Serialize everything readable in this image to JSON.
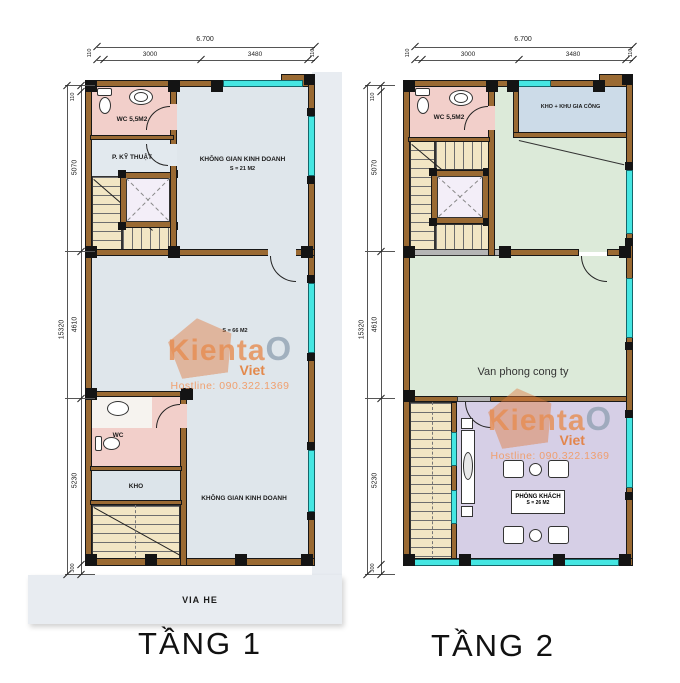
{
  "watermark": {
    "brand_main": "Kienta",
    "brand_o": "O",
    "sub": "Viet",
    "hotline": "Hostline: 090.322.1369"
  },
  "sidewalk_label": "VIA HE",
  "dims": {
    "top_total": "6.700",
    "seg_3000": "3000",
    "seg_3480": "3480",
    "end_110": "110",
    "left_total": "15320",
    "seg_110": "110",
    "seg_5070": "5070",
    "seg_4610": "4610",
    "seg_5230": "5230",
    "seg_300": "300"
  },
  "plans": [
    {
      "title": "TẦNG 1",
      "rooms": {
        "wc_top": "WC 5,5M2",
        "tech": "P. KỸ THUẬT",
        "business_top": "KHÔNG GIAN KINH DOANH",
        "business_top_area": "S = 21 M2",
        "open_area": "S = 66 M2",
        "wc_bottom": "WC",
        "storage": "KHO",
        "business_bottom": "KHÔNG GIAN KINH DOANH"
      }
    },
    {
      "title": "TẦNG 2",
      "rooms": {
        "wc_top": "WC 5,5M2",
        "storage_top": "KHO + KHU GIA CÔNG",
        "office": "Van phong cong ty",
        "living": "PHÒNG KHÁCH",
        "living_area": "S = 26 M2"
      }
    }
  ],
  "colors": {
    "wall": "#9a6a33",
    "window": "#45e6e2",
    "wc_floor": "#f2cfca",
    "retail_floor": "#dfe6eb",
    "office_floor": "#dcead9",
    "storage_floor": "#ccdbe8",
    "living_floor": "#d6cfe6",
    "stair_floor": "#f2e6c4",
    "sidewalk": "#e8ecf1",
    "watermark_orange": "#e8874d"
  }
}
